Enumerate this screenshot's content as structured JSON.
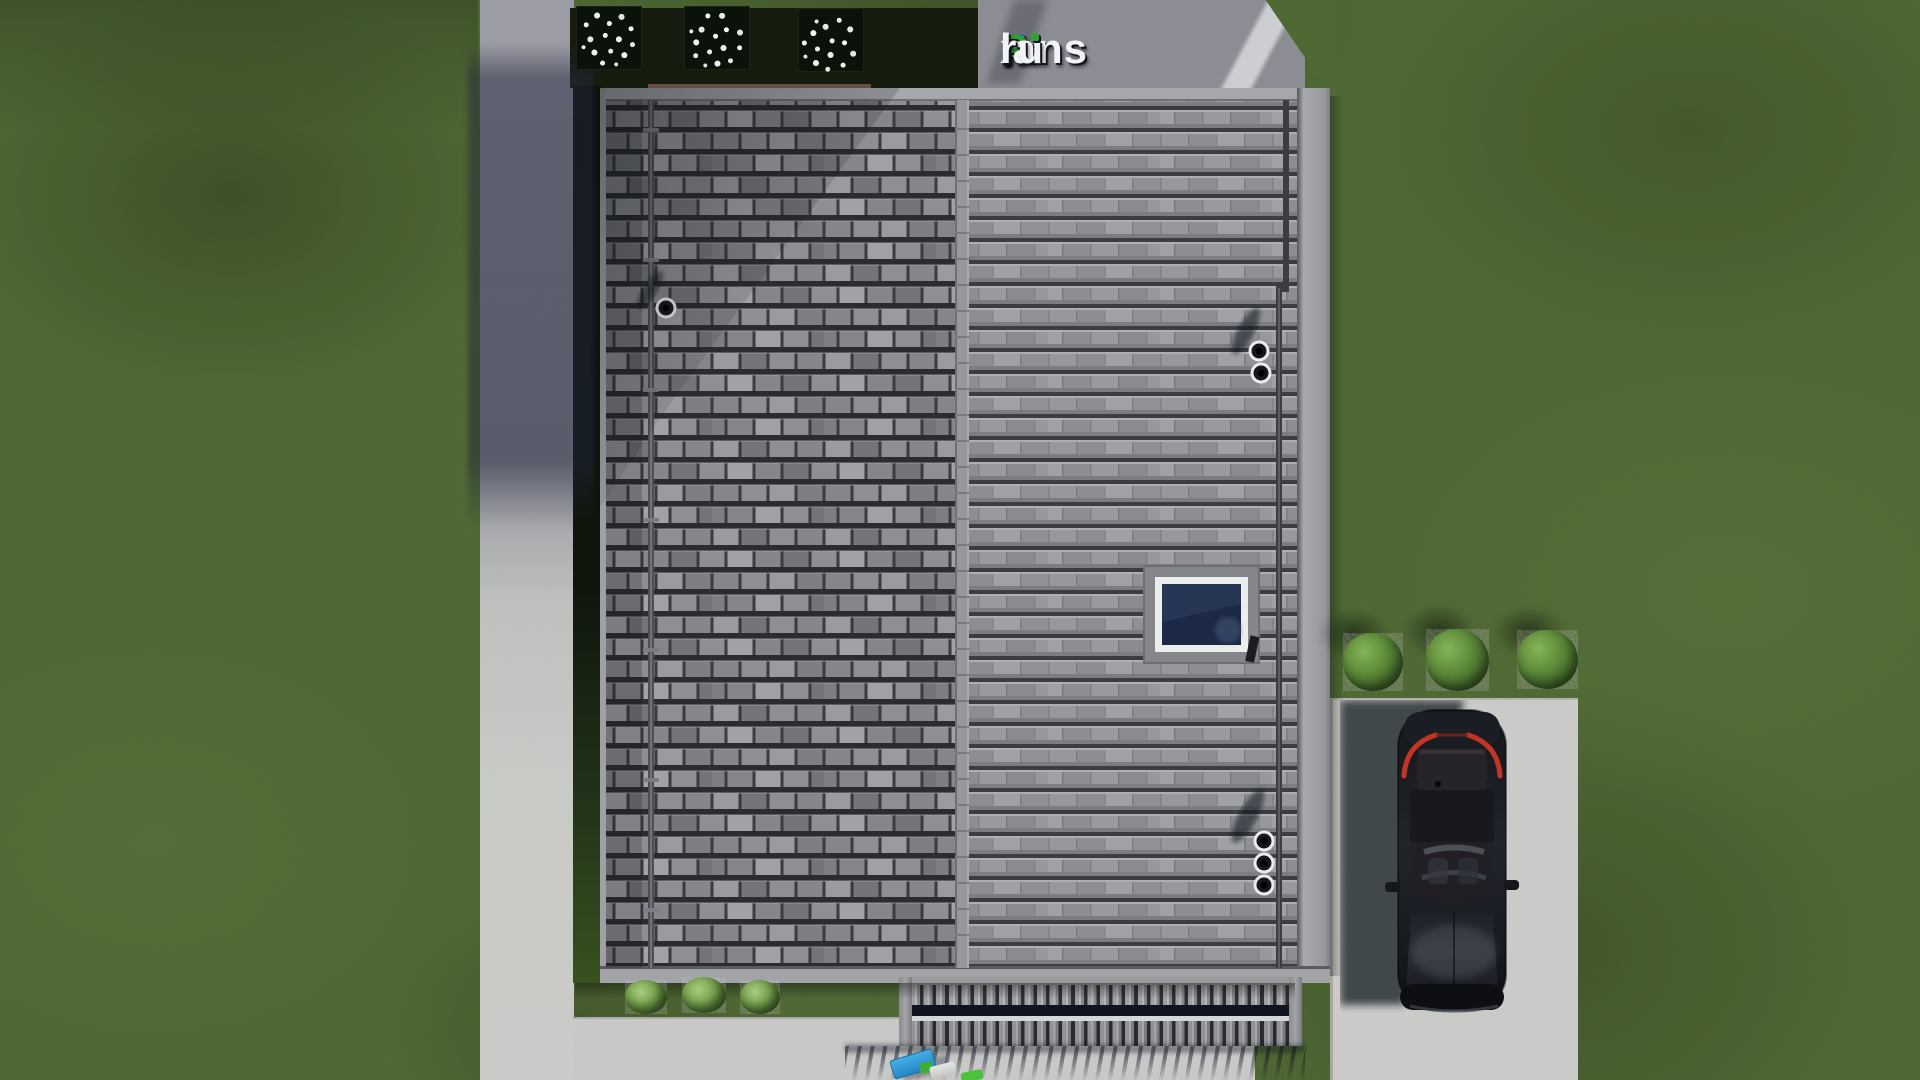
{
  "site": {
    "watermark_logo": {
      "text": "FixPlans.ru",
      "parts": [
        {
          "t": "F",
          "color": "blue"
        },
        {
          "t": "i",
          "color": "white",
          "dot": "green"
        },
        {
          "t": "x",
          "color": "white"
        },
        {
          "t": "P",
          "color": "green"
        },
        {
          "t": "lans",
          "color": "white"
        },
        {
          "t": ".",
          "color": "blue"
        },
        {
          "t": "ru",
          "color": "white"
        }
      ],
      "brand_colors": {
        "blue": "#1f63cf",
        "green": "#2fa032",
        "white": "#f2f3f5"
      }
    }
  },
  "scene": {
    "type": "3d-architectural-render-top-view",
    "description": "Aerial top-down render of a house plan: gray tiled gable roof with skylight and vent pipes, lawn, concrete paths, patio with louvered pergola, driveway with parked dark car, bushes and flower planters",
    "objects": [
      "lawn-grass",
      "concrete-path-left",
      "concrete-strip-top",
      "concrete-patio-bottom",
      "driveway",
      "garden-bed",
      "flower-planters",
      "wooden-edge-board",
      "house-roof-left-slope",
      "house-roof-right-slope",
      "roof-ridge",
      "roof-skylight",
      "roof-vent-single",
      "roof-vent-pair",
      "roof-vent-trio",
      "roof-downpipes",
      "pergola-louvers",
      "patio-objects",
      "bushes-right",
      "bushes-left",
      "parked-car"
    ],
    "palette": {
      "grass": "#4f6834",
      "grass_dark_patch": "#3c5426",
      "concrete_light": "#c9cac6",
      "concrete_shaded": "#8b8b92",
      "garden_bed_dark": "#121a0e",
      "wood_edge_brown": "#4a3832",
      "roof_tile_mid": "#8a8b90",
      "roof_tile_dark": "#3c3d42",
      "roof_ridge": "#97989c",
      "skylight_glass": "#1b2947",
      "skylight_frame_white": "#ecedee",
      "pergola_slat": "#9fa0a4",
      "car_body": "#14161b",
      "car_taillight_red": "#c23524",
      "object_blue": "#2e9bd8",
      "object_green": "#3fae36",
      "object_white": "#d9dad6",
      "shadow_navy": "#10141f"
    }
  }
}
